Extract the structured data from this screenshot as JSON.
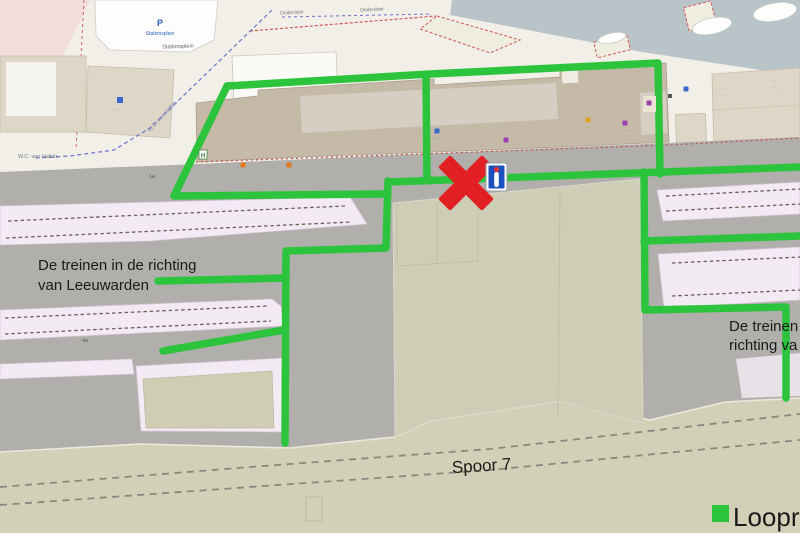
{
  "colors": {
    "route_green": "#2cc43c",
    "blocked_red": "#e22024",
    "info_blue": "#1c50be",
    "legend_green": "#2cc43c"
  },
  "legend": {
    "route_label": "Loopr"
  },
  "annotations": {
    "left_line1": "De treinen in de richting",
    "left_line2": "van Leeuwarden",
    "right_line1": "De treinen",
    "right_line2": "richting va",
    "track": "Spoor 7"
  },
  "map_labels": {
    "parking_symbol": "P",
    "parking_name": "Stationsplein",
    "street_station": "Stationsplein",
    "quay_label": "Onderdoor",
    "street_diagonal": "W.C. van Hallstr.",
    "street_left": "W.C. van Hallstr.",
    "platform_label_a": "1a",
    "platform_label_b": "4a",
    "bus_stop": "H",
    "illegible": "·····"
  }
}
